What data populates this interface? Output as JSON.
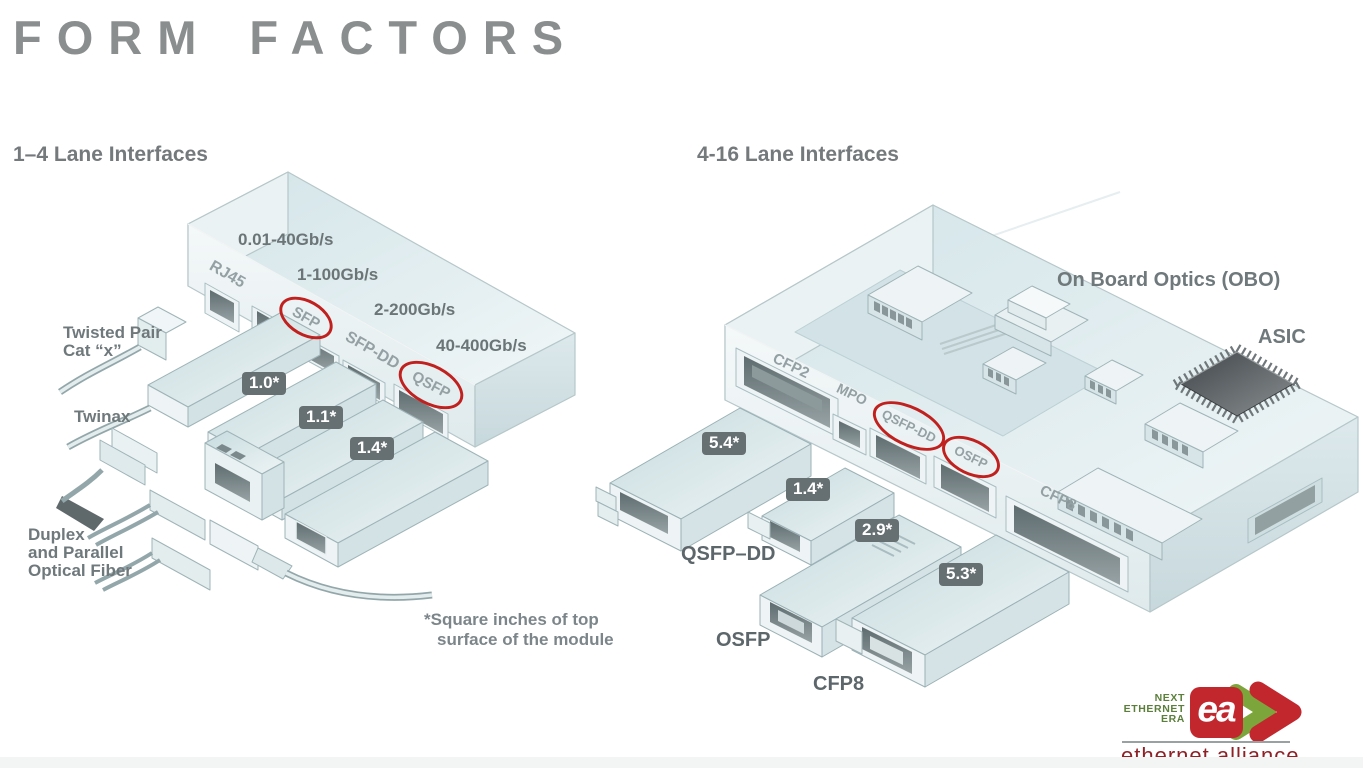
{
  "title": "FORM FACTORS",
  "left": {
    "heading": "1–4 Lane Interfaces",
    "speeds": [
      "0.01-40Gb/s",
      "1-100Gb/s",
      "2-200Gb/s",
      "40-400Gb/s"
    ],
    "ports": {
      "rj45": "RJ45",
      "sfp": "SFP",
      "sfp_dd": "SFP-DD",
      "qsfp": "QSFP"
    },
    "cables": {
      "twisted_pair_1": "Twisted Pair",
      "twisted_pair_2": "Cat “x”",
      "twinax": "Twinax",
      "fiber_1": "Duplex",
      "fiber_2": "and Parallel",
      "fiber_3": "Optical Fiber"
    },
    "badges": {
      "sfp": "1.0*",
      "sfp_dd": "1.1*",
      "qsfp": "1.4*"
    }
  },
  "right": {
    "heading": "4-16 Lane Interfaces",
    "ports": {
      "cfp2": "CFP2",
      "mpo": "MPO",
      "qsfp_dd": "QSFP-DD",
      "osfp": "OSFP",
      "cfp8": "CFP8"
    },
    "obo_label": "On Board Optics (OBO)",
    "asic_label": "ASIC",
    "modules": [
      {
        "size": "5.4*",
        "name": ""
      },
      {
        "size": "1.4*",
        "name": "QSFP–DD"
      },
      {
        "size": "2.9*",
        "name": "OSFP"
      },
      {
        "size": "5.3*",
        "name": "CFP8"
      }
    ]
  },
  "footnote": {
    "line1": "*Square inches of top",
    "line2": "surface of the module"
  },
  "logo": {
    "tagline": [
      "NEXT",
      "ETHERNET",
      "ERA"
    ],
    "monogram": "ea",
    "wordmark": "ethernet alliance"
  },
  "colors": {
    "accent_red": "#c0201e",
    "badge_bg": "#667072",
    "label_gray": "#6f797c",
    "title_gray": "#8a8e8f",
    "logo_green": "#5b7f3a",
    "logo_red": "#c1272d",
    "wordmark_red": "#8e2026"
  }
}
